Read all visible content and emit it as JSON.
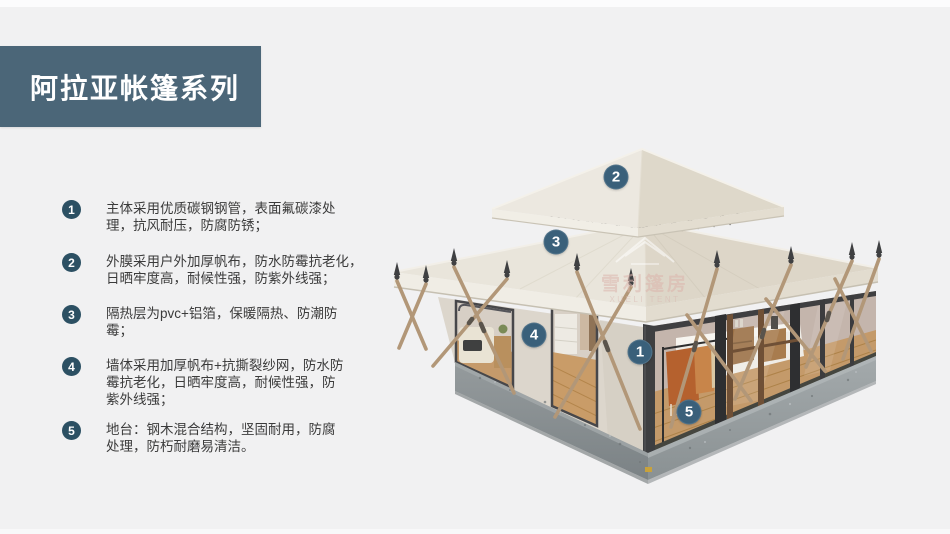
{
  "slide": {
    "background_color": "#f1f1f2",
    "title": "阿拉亚帐篷系列",
    "title_banner_color": "#4b6678",
    "title_text_color": "#ffffff"
  },
  "features": {
    "bullet_color": "#2c5063",
    "text_color": "#3b3b3b",
    "items": [
      {
        "num": "1",
        "text": "主体采用优质碳钢钢管，表面氟碳漆处\n理，抗风耐压，防腐防锈；"
      },
      {
        "num": "2",
        "text": "外膜采用户外加厚帆布，防水防霉抗老化，\n日晒牢度高，耐候性强，防紫外线强；"
      },
      {
        "num": "3",
        "text": "隔热层为pvc+铝箔，保暖隔热、防潮防\n霉；"
      },
      {
        "num": "4",
        "text": "墙体采用加厚帆布+抗撕裂纱网，防水防\n霉抗老化，日晒牢度高，耐候性强，防\n紫外线强；"
      },
      {
        "num": "5",
        "text": "地台：钢木混合结构，坚固耐用，防腐\n处理，防朽耐磨易清洁。"
      }
    ]
  },
  "diagram": {
    "marker_color": "#3a607a",
    "markers": [
      {
        "num": "1"
      },
      {
        "num": "2"
      },
      {
        "num": "3"
      },
      {
        "num": "4"
      },
      {
        "num": "5"
      }
    ],
    "watermark": {
      "cn": "雪利篷房",
      "en": "XUELI TENT"
    }
  }
}
